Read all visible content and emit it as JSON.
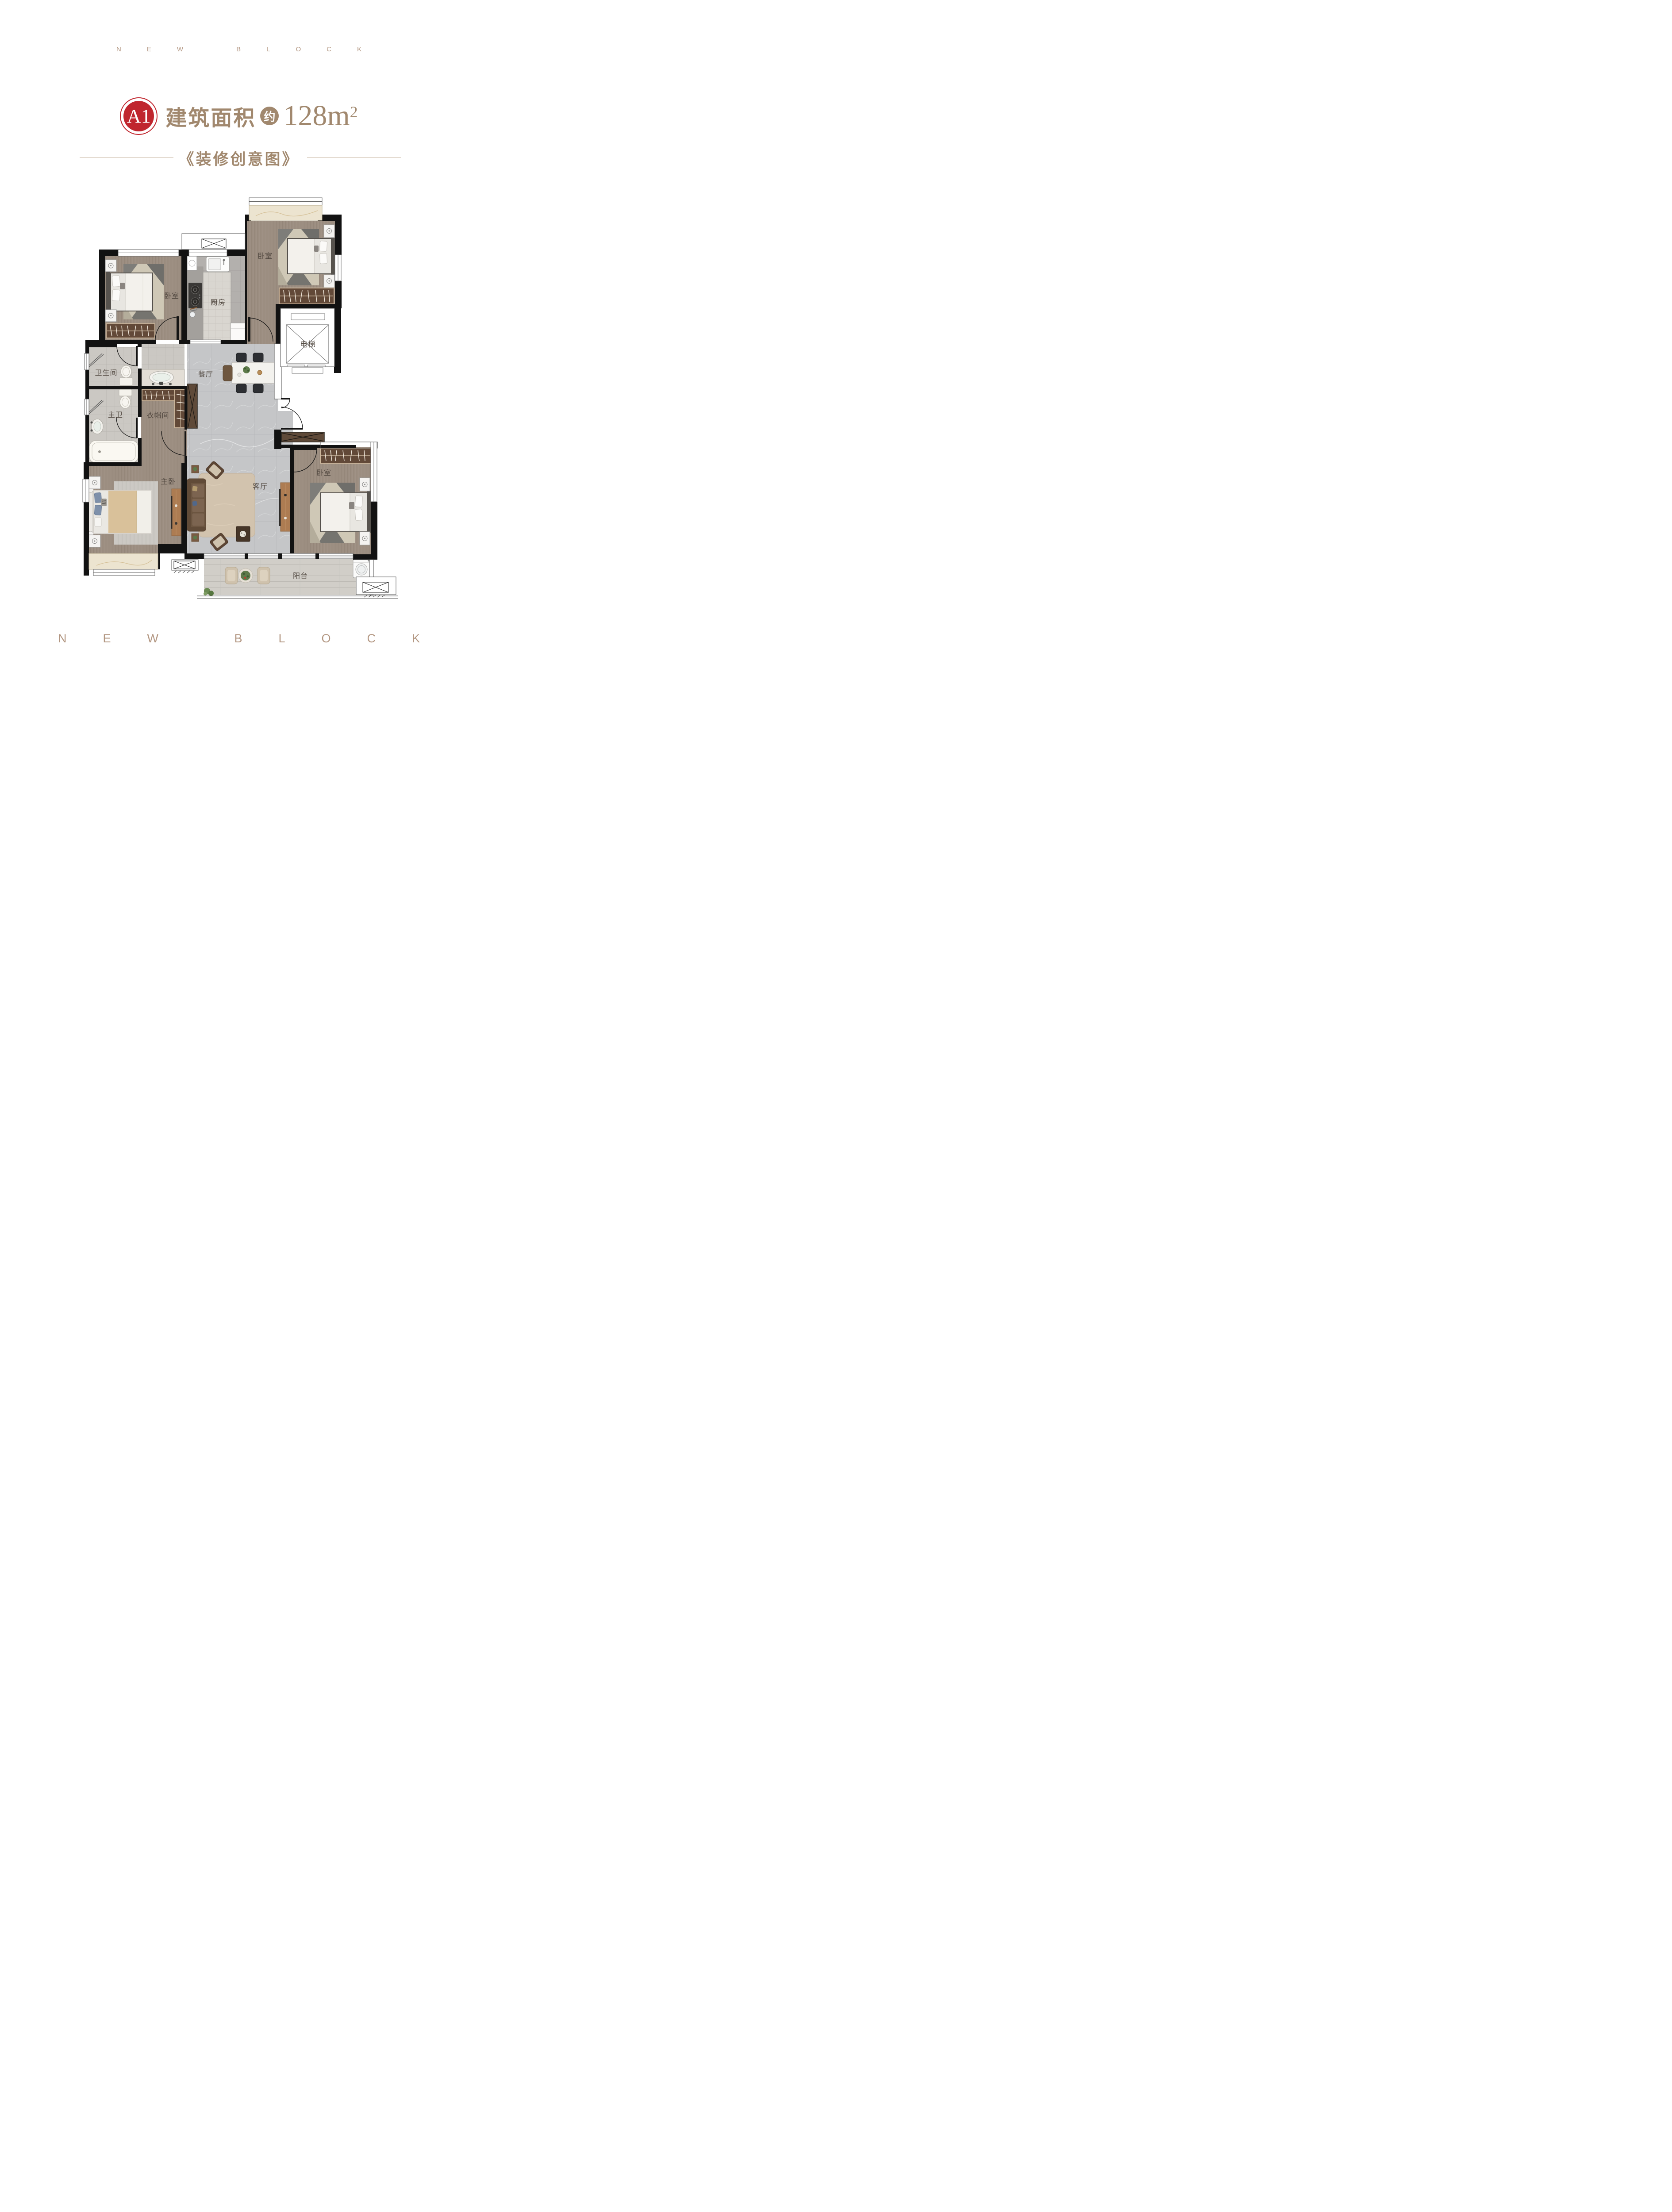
{
  "brand": {
    "top": "NEW BLOCK",
    "bottom": "NEW BLOCK"
  },
  "title": {
    "badge": "A1",
    "label": "建筑面积",
    "approx": "约",
    "area_value": "128",
    "area_unit": "m",
    "area_sup": "2"
  },
  "subtitle": "《装修创意图》",
  "colors": {
    "accent_red": "#c0262e",
    "title_brown": "#a1886e",
    "brand_letters": "#b29681",
    "plan_label": "#4f463e",
    "wall_black": "#121212"
  },
  "plan": {
    "rooms": [
      {
        "id": "bedroom-nw",
        "label": "卧室"
      },
      {
        "id": "kitchen",
        "label": "厨房"
      },
      {
        "id": "bedroom-ne",
        "label": "卧室"
      },
      {
        "id": "elevator",
        "label": "电梯"
      },
      {
        "id": "bathroom",
        "label": "卫生间"
      },
      {
        "id": "master-bathroom",
        "label": "主卫"
      },
      {
        "id": "cloakroom",
        "label": "衣帽间"
      },
      {
        "id": "dining-room",
        "label": "餐厅"
      },
      {
        "id": "master-bedroom",
        "label": "主卧"
      },
      {
        "id": "living-room",
        "label": "客厅"
      },
      {
        "id": "bedroom-se",
        "label": "卧室"
      },
      {
        "id": "balcony",
        "label": "阳台"
      }
    ]
  }
}
